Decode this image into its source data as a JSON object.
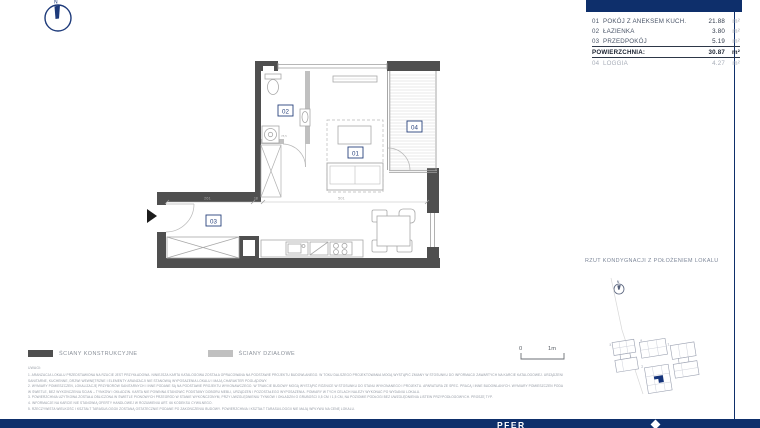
{
  "header": {
    "bar_color": "#0e2f6b"
  },
  "compass": {
    "north": "N"
  },
  "area_table": {
    "rows": [
      {
        "no": "01",
        "name": "POKÓJ Z ANEKSEM KUCH.",
        "value": "21.88",
        "unit": "m²"
      },
      {
        "no": "02",
        "name": "ŁAZIENKA",
        "value": "3.80",
        "unit": "m²"
      },
      {
        "no": "03",
        "name": "PRZEDPOKÓJ",
        "value": "5.19",
        "unit": "m²"
      }
    ],
    "total": {
      "label": "POWIERZCHNIA:",
      "value": "30.87",
      "unit": "m²"
    },
    "extra": {
      "no": "04",
      "name": "LOGGIA",
      "value": "4.27",
      "unit": "m²"
    }
  },
  "plan": {
    "room_labels": {
      "r1": "01",
      "r2": "02",
      "r3": "03",
      "r4": "04"
    },
    "dimensions": {
      "hall": "261",
      "wall": "18",
      "room": "501",
      "washer": "78,5"
    }
  },
  "legend": {
    "structural": "ŚCIANY KONSTRUKCYJNE",
    "partition": "ŚCIANY DZIAŁOWE"
  },
  "scale_bar": {
    "zero": "0",
    "one_meter": "1m"
  },
  "site_plan": {
    "title": "RZUT KONDYGNACJI Z POŁOŻENIEM LOKALU",
    "north": "N",
    "building_labels": [
      "1",
      "2",
      "3",
      "4"
    ]
  },
  "notes": {
    "heading": "UWAGI:",
    "lines": [
      "1. ARANŻACJA LOKALU PRZEDSTAWIONA NA RZUCIE JEST PRZYKŁADOWA. NINIEJSZA KARTA KATALOGOWA ZOSTAŁA OPRACOWANA NA PODSTAWIE PROJEKTU BUDOWLANEGO. W TOKU DALSZEGO PROJEKTOWANIA MOGĄ WYSTĄPIĆ ZMIANY W STOSUNKU DO INFORMACJI ZAWARTYCH NA KARCIE KATALOGOWEJ. URZĄDZENIA",
      "SANITARNE, KUCHENNE, DRZWI WEWNĘTRZNE I ELEMENTY ARANŻACJI NIE STANOWIĄ WYPOSAŻENIA LOKALU I MAJĄ CHARAKTER POGLĄDOWY.",
      "2. WYMIARY POMIESZCZEŃ, LOKALIZACJĘ PRZYBORÓW SANITARNYCH I INNE PODANE SĄ NA PODSTAWIE PROJEKTU WYKONAWCZEGO. W TRAKCIE BUDOWY MOGĄ WYSTĄPIĆ RÓŻNICE W STOSUNKU DO STANU WYKONANEGO I PROJEKTU. APARATURA ZE SPEC. PRACĄ I INNE BUDOWLANYCH. WYMIARY POMIESZCZEŃ PODANE",
      "W ŚWIETLE, BEZ WYKOŃCZENIA ŚCIAN – TYNKÓW I OKŁADZIN. KARTA NIE POWINNA STANOWIĆ PODSTAWY DOBORU MEBLI, URZĄDZEŃ I POZOSTAŁEGO WYPOSAŻENIA. POMIARY W TYCH CELACH NALEŻY WYKONAĆ PO WYDANIU LOKALU.",
      "3. POWIERZCHNIA UŻYTKOWA ZOSTAŁA OBLICZONA W ŚWIETLE PIONOWYCH PRZEGRÓD W STANIE WYKOŃCZONYM, PRZY UWZGLĘDNIENIU TYNKÓW I OKŁADZIN O GRUBOŚCI 0,5 CM I 1,5 CM, NA POZIOMIE PODŁOGI BEZ UWZGLĘDNIENIA LISTEW PRZYPODŁOGOWYCH. PROSZĘ TYP.",
      "4. INFORMACJE NA KARCIE NIE STANOWIĄ OFERTY HANDLOWEJ W ROZUMIENIU ART. 66 KODEKSU CYWILNEGO.",
      "5. RZECZYWISTA WIELKOŚĆ I KSZTAŁT TARASU/LOGGII ZOSTANĄ OSTATECZNIE PODANE PO ZAKOŃCZENIU BUDOWY. POWIERZCHNIA I KSZTAŁT TARASU/LOGGII NIE MAJĄ WPŁYWU NA CENĘ LOKALU."
    ]
  },
  "footer": {
    "brand_fragment": "PFER"
  }
}
